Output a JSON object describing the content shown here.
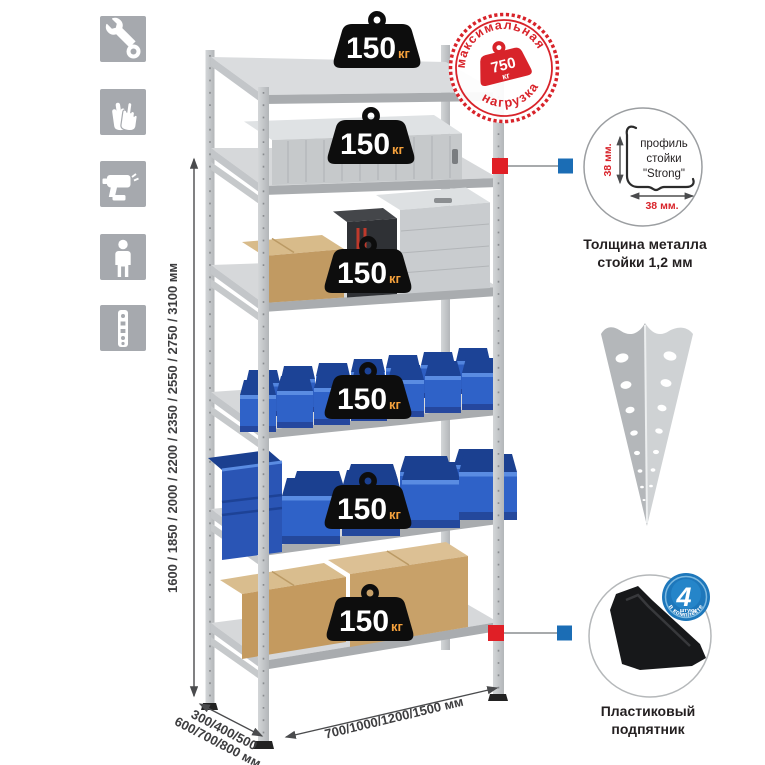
{
  "colors": {
    "accent_red": "#d8232a",
    "callout_red": "#e01f26",
    "callout_blue": "#1b6db5",
    "bin_blue": "#2d5ec2",
    "icon_bg": "#a6a9ae"
  },
  "left_toolbar": {
    "icons": [
      "wrench",
      "gloves",
      "drill",
      "person-height",
      "post-strip"
    ]
  },
  "dimensions": {
    "height": "1600 / 1850 / 2000 / 2200 / 2350 / 2550 / 2750 / 3100 мм",
    "depth_line1": "300/400/500",
    "depth_line2": "600/700/800 мм",
    "width": "700/1000/1200/1500 мм"
  },
  "shelf_load": {
    "value": "150",
    "unit": "кг"
  },
  "max_load_stamp": {
    "arc_top": "максимальная",
    "arc_bottom": "нагрузка",
    "value": "750",
    "unit": "кг"
  },
  "profile_detail": {
    "label_line1": "профиль",
    "label_line2": "стойки",
    "label_line3": "\"Strong\"",
    "dim_vertical": "38 мм.",
    "dim_horizontal": "38 мм.",
    "caption_line1": "Толщина металла",
    "caption_line2": "стойки 1,2 мм"
  },
  "foot_detail": {
    "badge_value": "4",
    "badge_unit": "штуки",
    "badge_arc": "в комплекте",
    "caption_line1": "Пластиковый",
    "caption_line2": "подпятник"
  }
}
